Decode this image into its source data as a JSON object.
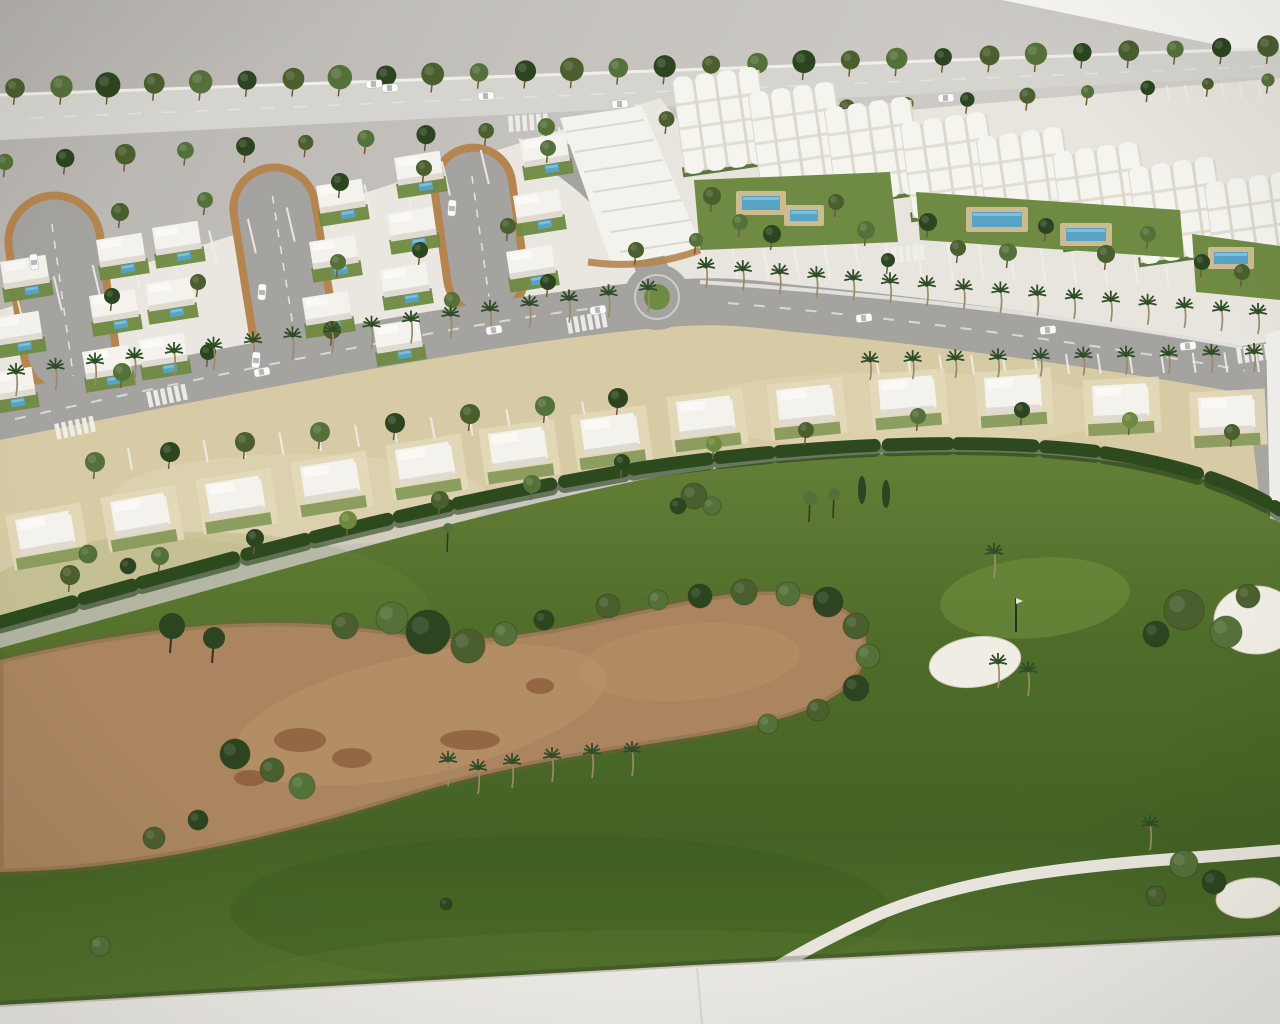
{
  "meta": {
    "description": "Photograph of an architectural scale model: white resort villas and apartment blocks with pools along palm-lined streets, bordering a golf course with a sandy waste area, bunkers and a cart path.",
    "text_content": "none"
  },
  "palette": {
    "wall": "#c7c4bf",
    "wall_dark": "#b6b3ae",
    "wall_light": "#d6d3ce",
    "paper": "#f8f7f4",
    "base": "#eae8e3",
    "base_edge": "#c6c3bc",
    "back_road": "#d6d4cf",
    "road": "#a5a3a0",
    "parking": "#b3b1ae",
    "ground_left": "#e9e7df",
    "ground_right": "#e7e5dd",
    "marking": "#efeeea",
    "villa": "#f4f2ec",
    "villa_shadow": "#d5d2c7",
    "apartment": "#f6f4ef",
    "apartment_shade": "#dcd8cd",
    "garden": "#6f8a42",
    "garden_light": "#81984f",
    "hedge": "#2d4a1e",
    "hedge_dark": "#24401a",
    "beige": "#d7cba6",
    "beige_light": "#e4dabb",
    "golf_top": "#647f37",
    "golf_mid": "#4e6c29",
    "golf_low": "#446225",
    "golf_bottom": "#55742e",
    "green_light": "#72913f",
    "waste": "#aa855f",
    "waste_light": "#bb9569",
    "waste_dark": "#7c5c3e",
    "stain": "#6e3a1c",
    "tree_dark": "#2c4520",
    "tree_olive": "#4a5e2e",
    "tree_mid": "#55713a",
    "tree_light": "#6f8a3f",
    "trunk": "#6e5a3c",
    "palm_crown": "#2f4d26",
    "palm_trunk": "#9a8a6a",
    "pool": "#57a3c6",
    "pool_light": "#8cc6dc",
    "deck": "#cdbb90",
    "bunker": "#f0ede4",
    "path": "#e8e5dd",
    "car": "#fafaf8",
    "curb": "#b5854f"
  },
  "scene": {
    "tree_rows": [
      {
        "x1": 15,
        "y1": 88,
        "x2": 1268,
        "y2": 46,
        "count": 28,
        "r": 12,
        "scale_end": 0.85
      },
      {
        "x1": 5,
        "y1": 162,
        "x2": 1268,
        "y2": 80,
        "count": 22,
        "r": 10,
        "scale_end": 0.7
      }
    ],
    "bay_groups": [
      {
        "x1": 15,
        "y1": 288,
        "x2": 636,
        "y2": 104,
        "count": 17,
        "dx": 8,
        "dy": 34
      },
      {
        "x1": 700,
        "y1": 238,
        "x2": 1256,
        "y2": 244,
        "count": 19,
        "dx": 3,
        "dy": 20
      },
      {
        "x1": 704,
        "y1": 258,
        "x2": 1258,
        "y2": 266,
        "count": 19,
        "dx": 3,
        "dy": 20
      },
      {
        "x1": 876,
        "y1": 356,
        "x2": 1256,
        "y2": 352,
        "count": 13,
        "dx": 3,
        "dy": 20
      },
      {
        "x1": 1148,
        "y1": 86,
        "x2": 1258,
        "y2": 82,
        "count": 7,
        "dx": 3,
        "dy": 16
      },
      {
        "x1": 128,
        "y1": 448,
        "x2": 620,
        "y2": 398,
        "count": 14,
        "dx": 4,
        "dy": 22
      }
    ],
    "loops": [
      {
        "cx": 48,
        "cy": 196,
        "w": 92,
        "h": 200,
        "rot": -8
      },
      {
        "cx": 268,
        "cy": 168,
        "w": 82,
        "h": 205,
        "rot": -9
      },
      {
        "cx": 468,
        "cy": 148,
        "w": 78,
        "h": 168,
        "rot": -8
      }
    ],
    "villa_columns": [
      {
        "x": 0,
        "y": 262,
        "dx": -7,
        "dy": 56,
        "count": 3
      },
      {
        "x": 96,
        "y": 240,
        "dx": -7,
        "dy": 56,
        "count": 3
      },
      {
        "x": 152,
        "y": 228,
        "dx": -7,
        "dy": 56,
        "count": 3
      },
      {
        "x": 316,
        "y": 186,
        "dx": -7,
        "dy": 56,
        "count": 3
      },
      {
        "x": 394,
        "y": 158,
        "dx": -7,
        "dy": 56,
        "count": 4
      },
      {
        "x": 520,
        "y": 140,
        "dx": -7,
        "dy": 56,
        "count": 3
      }
    ],
    "townhouse_strip": {
      "pts": "560,118 642,106 702,248 612,266",
      "curb": "M 588 262 C 630 268, 668 262, 700 250"
    },
    "mid_villas": [
      [
        15,
        520,
        -10
      ],
      [
        110,
        502,
        -10
      ],
      [
        205,
        484,
        -9
      ],
      [
        300,
        467,
        -9
      ],
      [
        395,
        450,
        -9
      ],
      [
        488,
        434,
        -8
      ],
      [
        580,
        420,
        -8
      ],
      [
        676,
        402,
        -7
      ],
      [
        776,
        390,
        -6
      ],
      [
        878,
        380,
        -5
      ],
      [
        984,
        378,
        -4
      ],
      [
        1092,
        386,
        -3
      ],
      [
        1198,
        398,
        -3
      ]
    ],
    "apartments": {
      "x": 672,
      "y": 82,
      "dx": 76,
      "dy": 15,
      "count": 8,
      "w": 88,
      "h": 92,
      "rot": -8
    },
    "gardens": [
      {
        "pts": "694,180 890,172 898,242 700,250"
      },
      {
        "pts": "916,192 1180,210 1184,258 920,240"
      },
      {
        "pts": "1192,234 1280,246 1280,300 1196,292"
      }
    ],
    "pools": [
      [
        742,
        196,
        38,
        14
      ],
      [
        790,
        210,
        28,
        11
      ],
      [
        972,
        212,
        50,
        15
      ],
      [
        1066,
        228,
        40,
        13
      ],
      [
        1214,
        252,
        34,
        12
      ]
    ],
    "garden_trees": [
      [
        712,
        196,
        9
      ],
      [
        740,
        222,
        8
      ],
      [
        772,
        234,
        9
      ],
      [
        836,
        202,
        8
      ],
      [
        866,
        230,
        9
      ],
      [
        928,
        222,
        9
      ],
      [
        958,
        248,
        8
      ],
      [
        1008,
        252,
        9
      ],
      [
        1046,
        226,
        8
      ],
      [
        1106,
        254,
        9
      ],
      [
        1148,
        234,
        8
      ],
      [
        1202,
        262,
        8
      ],
      [
        1242,
        272,
        8
      ],
      [
        696,
        240,
        7
      ],
      [
        888,
        260,
        7
      ]
    ],
    "palm_rows": [
      {
        "x1": 16,
        "y1": 396,
        "x2": 648,
        "y2": 312,
        "count": 17,
        "h": 24
      },
      {
        "x1": 706,
        "y1": 288,
        "x2": 1258,
        "y2": 334,
        "count": 16,
        "h": 22
      },
      {
        "x1": 870,
        "y1": 380,
        "x2": 1254,
        "y2": 372,
        "count": 10,
        "h": 20
      }
    ],
    "district_trees": [
      [
        120,
        212,
        9
      ],
      [
        205,
        200,
        8
      ],
      [
        340,
        182,
        9
      ],
      [
        424,
        168,
        8
      ],
      [
        548,
        148,
        8
      ],
      [
        112,
        296,
        8
      ],
      [
        198,
        282,
        8
      ],
      [
        338,
        262,
        8
      ],
      [
        420,
        250,
        8
      ],
      [
        508,
        226,
        8
      ],
      [
        122,
        372,
        9
      ],
      [
        208,
        352,
        8
      ],
      [
        332,
        330,
        9
      ],
      [
        452,
        300,
        8
      ],
      [
        548,
        282,
        8
      ],
      [
        636,
        250,
        8
      ]
    ],
    "road_trees": [
      [
        95,
        462,
        10
      ],
      [
        170,
        452,
        10
      ],
      [
        245,
        442,
        10
      ],
      [
        320,
        432,
        10
      ],
      [
        395,
        423,
        10
      ],
      [
        470,
        414,
        10
      ],
      [
        545,
        406,
        10
      ],
      [
        618,
        398,
        10
      ]
    ],
    "mid_band_trees": [
      [
        70,
        575,
        10
      ],
      [
        160,
        556,
        9
      ],
      [
        255,
        538,
        9
      ],
      [
        348,
        520,
        9
      ],
      [
        440,
        500,
        9
      ],
      [
        532,
        484,
        9
      ],
      [
        622,
        462,
        8
      ],
      [
        714,
        444,
        8
      ],
      [
        806,
        430,
        8
      ],
      [
        918,
        416,
        8
      ],
      [
        1022,
        410,
        8
      ],
      [
        1130,
        420,
        8
      ],
      [
        1232,
        432,
        8
      ]
    ],
    "golf_bushes": [
      [
        345,
        626,
        13
      ],
      [
        392,
        618,
        16
      ],
      [
        428,
        632,
        22
      ],
      [
        468,
        646,
        17
      ],
      [
        505,
        634,
        12
      ],
      [
        544,
        620,
        10
      ],
      [
        608,
        606,
        12
      ],
      [
        658,
        600,
        10
      ],
      [
        700,
        596,
        12
      ],
      [
        744,
        592,
        13
      ],
      [
        788,
        594,
        12
      ],
      [
        828,
        602,
        15
      ],
      [
        856,
        626,
        13
      ],
      [
        868,
        656,
        12
      ],
      [
        856,
        688,
        13
      ],
      [
        818,
        710,
        11
      ],
      [
        768,
        724,
        10
      ],
      [
        235,
        754,
        15
      ],
      [
        272,
        770,
        12
      ],
      [
        302,
        786,
        13
      ],
      [
        198,
        820,
        10
      ],
      [
        154,
        838,
        11
      ],
      [
        88,
        554,
        9
      ],
      [
        128,
        566,
        8
      ],
      [
        694,
        496,
        13
      ],
      [
        712,
        506,
        9
      ],
      [
        678,
        506,
        8
      ],
      [
        1184,
        610,
        20
      ],
      [
        1226,
        632,
        16
      ],
      [
        1156,
        634,
        13
      ],
      [
        1248,
        596,
        12
      ],
      [
        1184,
        864,
        14
      ],
      [
        1214,
        882,
        12
      ],
      [
        1156,
        896,
        10
      ],
      [
        100,
        946,
        10
      ],
      [
        446,
        904,
        6
      ]
    ],
    "dark_trees": [
      [
        172,
        626,
        13
      ],
      [
        214,
        638,
        11
      ]
    ],
    "thin_trees": [
      [
        810,
        498,
        7
      ],
      [
        834,
        494,
        6
      ],
      [
        448,
        528,
        5
      ]
    ],
    "cypresses": [
      [
        862,
        490
      ],
      [
        886,
        494
      ]
    ],
    "golf_palms": [
      [
        448,
        786
      ],
      [
        478,
        794
      ],
      [
        512,
        788
      ],
      [
        552,
        782
      ],
      [
        592,
        778
      ],
      [
        632,
        776
      ],
      [
        998,
        688
      ],
      [
        1028,
        696
      ],
      [
        1150,
        850
      ],
      [
        994,
        578
      ]
    ],
    "bunkers": [
      [
        975,
        662,
        46,
        25,
        -8
      ],
      [
        1256,
        620,
        42,
        34,
        0
      ],
      [
        1250,
        898,
        34,
        20,
        -5
      ]
    ],
    "pin": {
      "x": 1016,
      "y1": 598,
      "y2": 632
    },
    "stains": [
      [
        300,
        740,
        26,
        12
      ],
      [
        352,
        758,
        20,
        10
      ],
      [
        470,
        740,
        30,
        10
      ],
      [
        540,
        686,
        14,
        8
      ],
      [
        250,
        778,
        16,
        8
      ]
    ],
    "cars": [
      [
        374,
        84,
        -3
      ],
      [
        390,
        88,
        -3
      ],
      [
        486,
        96,
        -3
      ],
      [
        620,
        104,
        -3
      ],
      [
        946,
        98,
        -3
      ],
      [
        262,
        372,
        -11
      ],
      [
        494,
        330,
        -10
      ],
      [
        598,
        310,
        -9
      ],
      [
        864,
        318,
        -7
      ],
      [
        1048,
        330,
        -6
      ],
      [
        1188,
        346,
        -6
      ],
      [
        34,
        262,
        -96
      ],
      [
        262,
        292,
        -86
      ],
      [
        256,
        360,
        -86
      ],
      [
        452,
        208,
        -85
      ]
    ],
    "crosswalks": [
      [
        508,
        116,
        -4
      ],
      [
        54,
        424,
        -12
      ],
      [
        146,
        392,
        -12
      ],
      [
        566,
        318,
        -10
      ],
      [
        884,
        248,
        -6
      ],
      [
        1236,
        348,
        -8
      ]
    ]
  }
}
